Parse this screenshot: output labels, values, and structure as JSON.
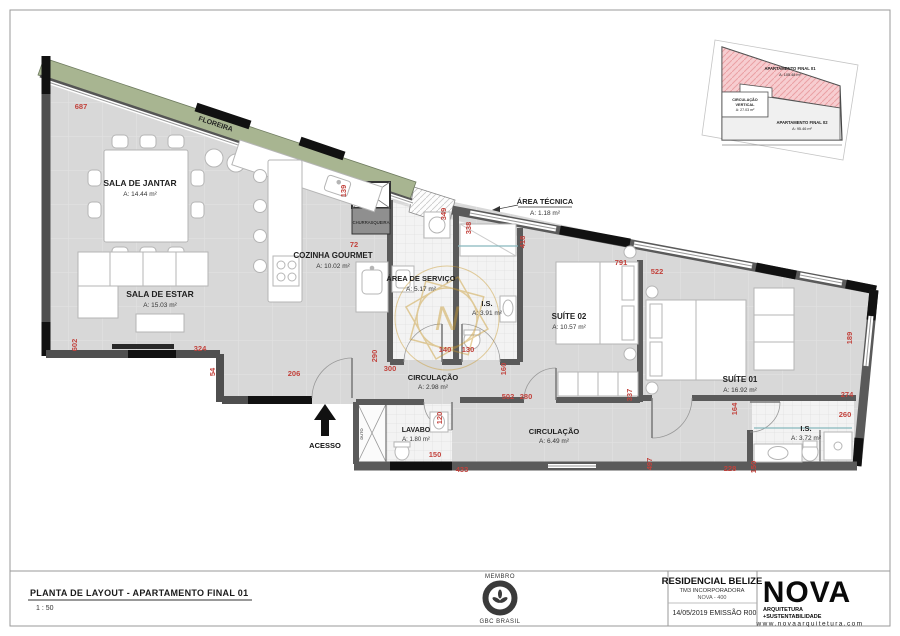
{
  "title_block": {
    "drawing_title": "PLANTA DE LAYOUT - APARTAMENTO FINAL 01",
    "scale": "1 : 50",
    "member_label": "MEMBRO",
    "member_org": "GBC BRASIL",
    "project_name": "RESIDENCIAL BELIZE",
    "developer": "TM3 INCORPORADORA",
    "project_code": "NOVA - 400",
    "date": "14/05/2019",
    "revision": "EMISSÃO R00",
    "logo_text": "NOVA",
    "logo_subtitle_1": "ARQUITETURA",
    "logo_subtitle_2": "+SUSTENTABILIDADE",
    "website": "www.novaarquitetura.com"
  },
  "rooms": [
    {
      "name": "SALA DE JANTAR",
      "area": "A: 14.44 m²"
    },
    {
      "name": "SALA DE ESTAR",
      "area": "A: 15.03 m²"
    },
    {
      "name": "COZINHA GOURMET",
      "area": "A: 10.02 m²"
    },
    {
      "name": "ÁREA DE SERVIÇO",
      "area": "A: 5.17 m²"
    },
    {
      "name": "I.S.",
      "area": "A: 3.91 m²"
    },
    {
      "name": "SUÍTE 02",
      "area": "A: 10.57 m²"
    },
    {
      "name": "SUÍTE 01",
      "area": "A: 16.92 m²"
    },
    {
      "name": "CIRCULAÇÃO",
      "area": "A: 2.98 m²"
    },
    {
      "name": "CIRCULAÇÃO",
      "area": "A: 6.49 m²"
    },
    {
      "name": "LAVABO",
      "area": "A: 1.80 m²"
    },
    {
      "name": "I.S.",
      "area": "A: 3.72 m²"
    },
    {
      "name": "ÁREA TÉCNICA",
      "area": "A: 1.18 m²"
    }
  ],
  "plan_labels": {
    "floreira": "FLOREIRA",
    "acesso": "ACESSO",
    "churrasqueira": "CHURRASQUEIRA",
    "duto": "DUTO"
  },
  "dims": [
    "687",
    "139",
    "72",
    "602",
    "324",
    "54",
    "206",
    "290",
    "300",
    "140",
    "130",
    "160",
    "502",
    "280",
    "120",
    "150",
    "433",
    "791",
    "522",
    "349",
    "338",
    "418",
    "337",
    "189",
    "274",
    "260",
    "164",
    "497",
    "228",
    "150"
  ],
  "inset": {
    "apt1_label": "APARTAMENTO FINAL 01",
    "apt1_area": "A: 105.48 m²",
    "circ_label_1": "CIRCULAÇÃO",
    "circ_label_2": "VERTICAL",
    "circ_area": "A: 27.03 m²",
    "apt2_label": "APARTAMENTO FINAL 02",
    "apt2_area": "A: 95.46 m²"
  },
  "watermark": {
    "letter": "N"
  },
  "colors": {
    "dim_red": "#c2423c",
    "floreira_green": "#a8b591",
    "inset_pink": "#f7cdd0",
    "watermark_gold": "#c9992e",
    "wall_gray": "#4f4f4f"
  }
}
